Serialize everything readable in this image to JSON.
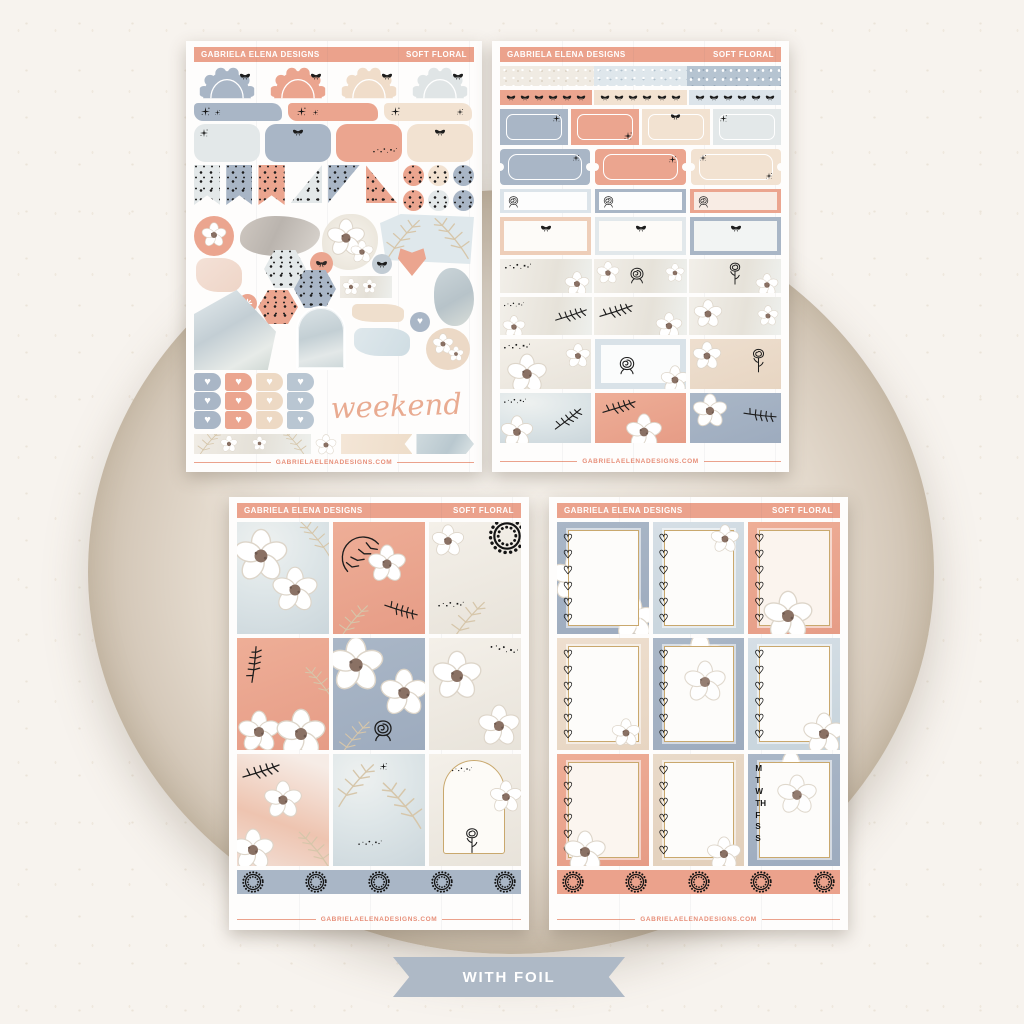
{
  "brand": {
    "name": "GABRIELA ELENA DESIGNS",
    "collection": "SOFT FLORAL",
    "website": "GABRIELAELENADESIGNS.COM"
  },
  "page": {
    "banner_label": "WITH FOIL"
  },
  "sheet1": {
    "weekend_text": "weekend"
  },
  "sheet4": {
    "weekday_letters": [
      "M",
      "T",
      "W",
      "TH",
      "F",
      "S",
      "S"
    ]
  },
  "palette": {
    "salmon": "#EBA28C",
    "blue_gray": "#A9B6C6",
    "light_blue": "#DCE4EA",
    "cream": "#F2E2D1",
    "light_gray": "#E3E8E9",
    "gold_foil": "#C9A86D",
    "ink_black": "#1D1D1D",
    "banner_blue": "#AEB9C6",
    "footer_text": "#E78F79",
    "background": "#F7F3EE",
    "backdrop_circle": "#E9E0D5"
  }
}
